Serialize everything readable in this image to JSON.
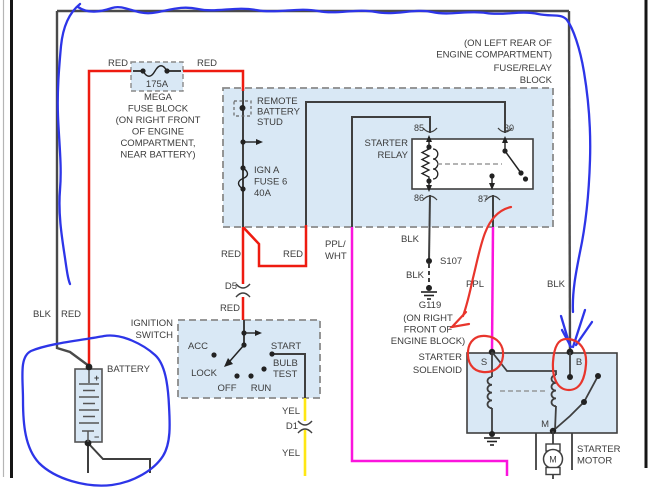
{
  "colors": {
    "wire_black": "#3f3f3f",
    "wire_red": "#ee1b10",
    "wire_magenta": "#fb14dd",
    "wire_yellow": "#ffe714",
    "annotation_blue": "#2d35e8",
    "annotation_red": "#e8352c",
    "box_fill": "#d9e8f5"
  },
  "fuse_relay_block": {
    "location": [
      "(ON LEFT REAR OF",
      "ENGINE COMPARTMENT)",
      "FUSE/RELAY",
      "BLOCK"
    ],
    "remote_stud": [
      "REMOTE",
      "BATTERY",
      "STUD"
    ],
    "ign_fuse": [
      "IGN A",
      "FUSE 6",
      "40A"
    ],
    "relay_label": [
      "STARTER",
      "RELAY"
    ],
    "terminals": {
      "t85": "85",
      "t30": "30",
      "t86": "86",
      "t87": "87"
    }
  },
  "mega_fuse": {
    "rating": "175A",
    "caption": [
      "MEGA",
      "FUSE BLOCK",
      "(ON RIGHT FRONT",
      "OF ENGINE",
      "COMPARTMENT,",
      "NEAR BATTERY)"
    ]
  },
  "wire_labels": {
    "red_top_left": "RED",
    "red_top_right": "RED",
    "red_mid": "RED",
    "red_branch": "RED",
    "d5": "D5",
    "red_below_d5": "RED",
    "ppl_wht": [
      "PPL/",
      "WHT"
    ],
    "blk_86": "BLK",
    "s107": "S107",
    "blk_s107": "BLK",
    "g119": "G119",
    "g119_loc": [
      "(ON RIGHT",
      "FRONT OF",
      "ENGINE BLOCK)"
    ],
    "ppl": "PPL",
    "blk_right": "BLK",
    "blk_batt": "BLK",
    "red_batt": "RED",
    "yel_1": "YEL",
    "d1": "D1",
    "yel_2": "YEL"
  },
  "ignition_switch": {
    "label": [
      "IGNITION",
      "SWITCH"
    ],
    "positions": {
      "acc": "ACC",
      "lock": "LOCK",
      "off": "OFF",
      "run": "RUN",
      "start": "START",
      "bulb_test": [
        "BULB",
        "TEST"
      ]
    }
  },
  "battery": {
    "label": "BATTERY",
    "plus": "+",
    "minus": "−"
  },
  "starter_solenoid": {
    "label": [
      "STARTER",
      "SOLENOID"
    ],
    "terminal_s": "S",
    "terminal_b": "B",
    "terminal_m": "M"
  },
  "starter_motor": {
    "label": [
      "STARTER",
      "MOTOR"
    ],
    "symbol": "M"
  }
}
